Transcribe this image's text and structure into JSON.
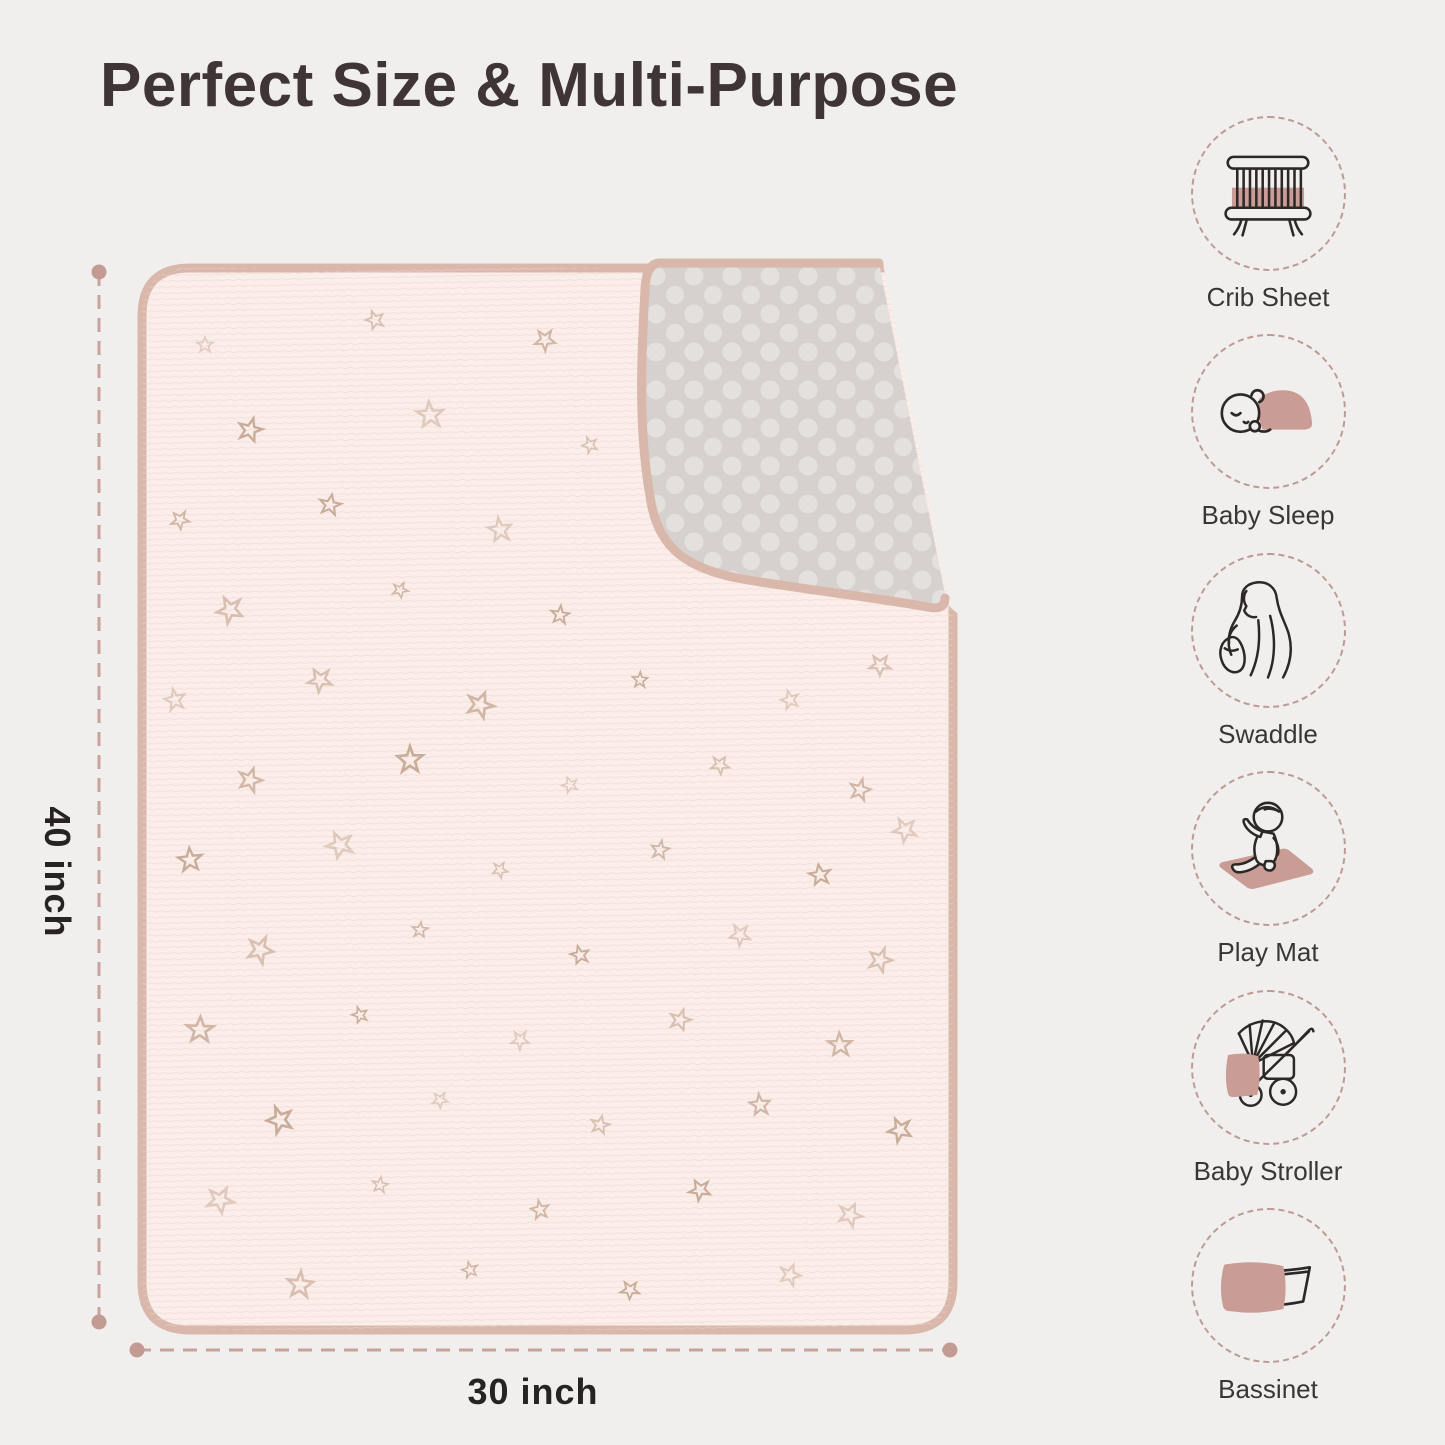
{
  "title": "Perfect Size & Multi-Purpose",
  "dimensions": {
    "height_label": "40 inch",
    "width_label": "30 inch"
  },
  "uses": [
    {
      "label": "Crib Sheet",
      "icon": "crib-icon"
    },
    {
      "label": "Baby Sleep",
      "icon": "sleeping-baby-icon"
    },
    {
      "label": "Swaddle",
      "icon": "swaddle-mother-icon"
    },
    {
      "label": "Play Mat",
      "icon": "play-mat-baby-icon"
    },
    {
      "label": "Baby Stroller",
      "icon": "stroller-icon"
    },
    {
      "label": "Bassinet",
      "icon": "bassinet-icon"
    }
  ],
  "colors": {
    "background": "#f1efed",
    "accent_pink": "#ca9c96",
    "binding_tan": "#d9b8ab",
    "blanket_pink": "#fbeeea",
    "minky_gray": "#d6d1ce",
    "dimension_line": "#c7a39b",
    "star_tan": "#bfa08b",
    "title_text": "#3f3537",
    "label_text": "#3a3636"
  }
}
